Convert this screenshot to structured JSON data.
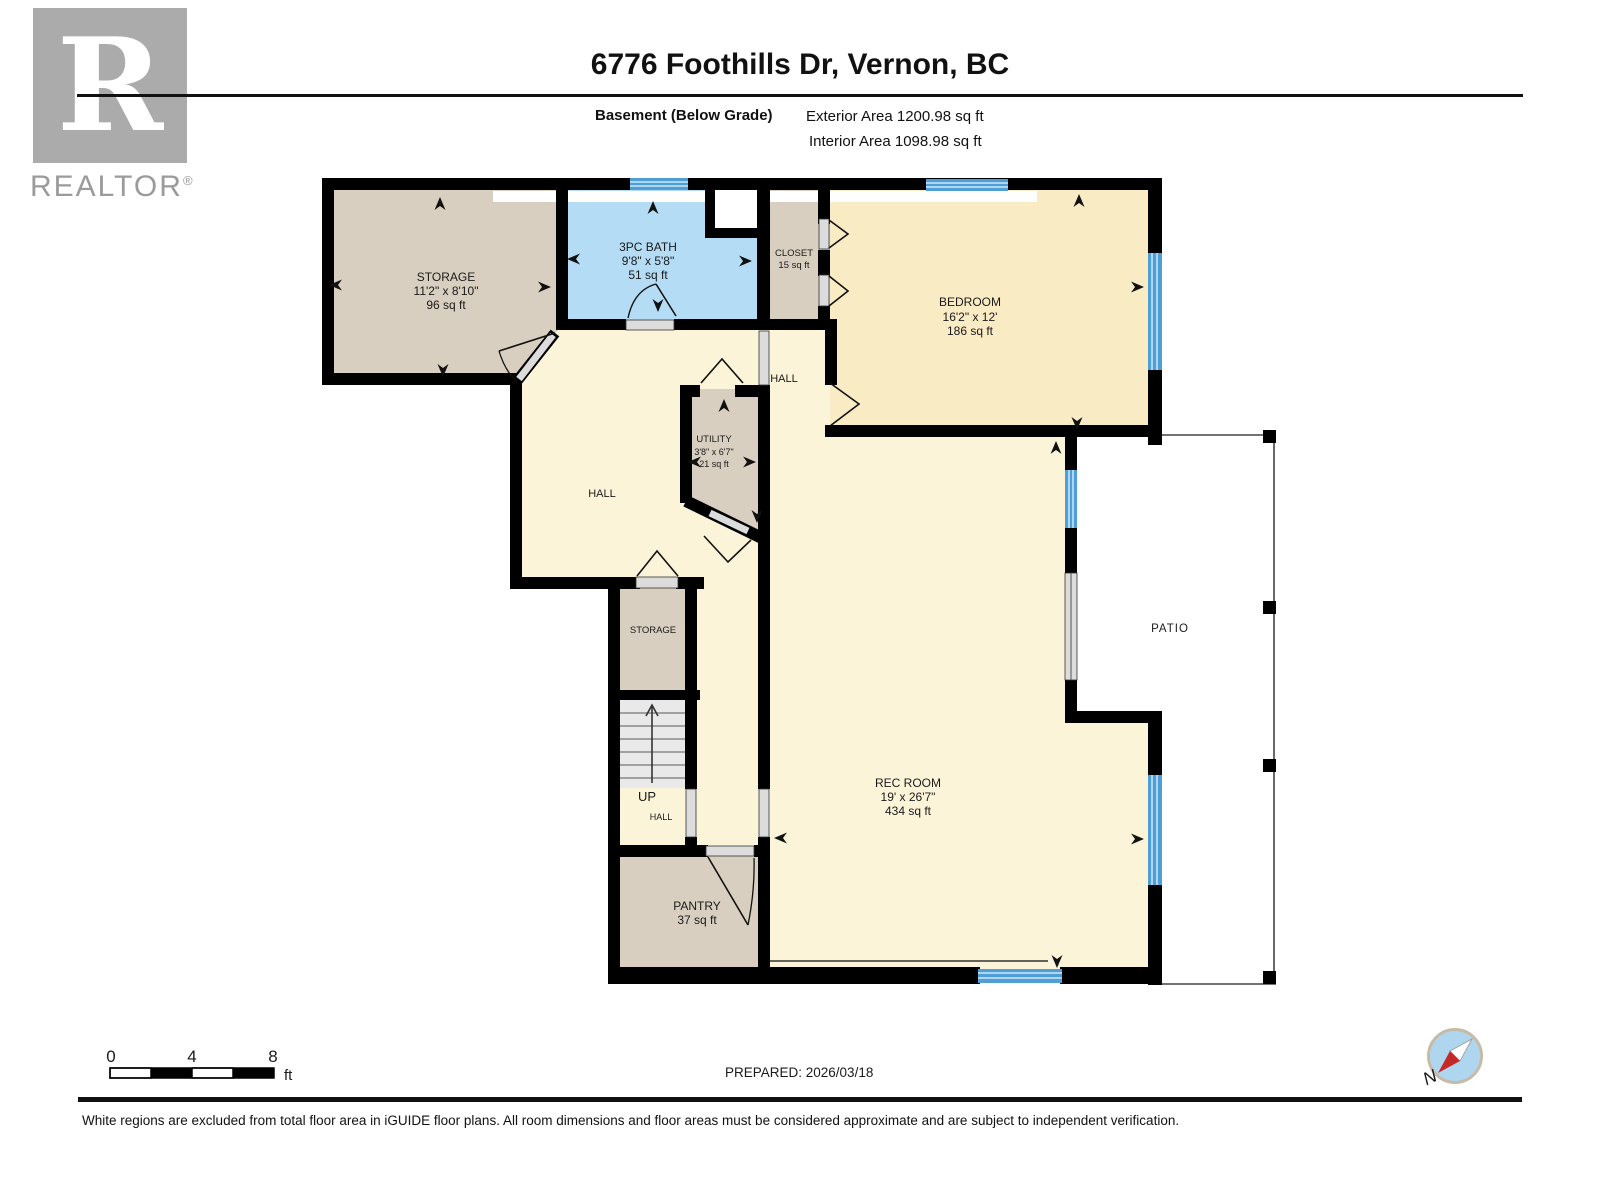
{
  "header": {
    "logo": {
      "letter": "R",
      "brand": "REALTOR",
      "reg": "®"
    },
    "title": "6776 Foothills Dr, Vernon, BC",
    "floor_label": "Basement (Below Grade)",
    "exterior_area": "Exterior Area 1200.98 sq ft",
    "interior_area": "Interior Area 1098.98 sq ft"
  },
  "plan": {
    "rooms": {
      "storage_main": {
        "name": "STORAGE",
        "dims": "11'2\" x 8'10\"",
        "area": "96 sq ft"
      },
      "bath": {
        "name": "3PC BATH",
        "dims": "9'8\" x 5'8\"",
        "area": "51 sq ft"
      },
      "closet": {
        "name": "CLOSET",
        "area": "15 sq ft"
      },
      "bedroom": {
        "name": "BEDROOM",
        "dims": "16'2\" x 12'",
        "area": "186 sq ft"
      },
      "utility": {
        "name": "UTILITY",
        "dims": "3'8\" x 6'7\"",
        "area": "21 sq ft"
      },
      "hall_left": {
        "name": "HALL"
      },
      "hall_right": {
        "name": "HALL"
      },
      "hall_small": {
        "name": "HALL"
      },
      "storage_small": {
        "name": "STORAGE"
      },
      "stairs": {
        "name": "UP"
      },
      "pantry": {
        "name": "PANTRY",
        "area": "37 sq ft"
      },
      "rec": {
        "name": "REC ROOM",
        "dims": "19' x 26'7\"",
        "area": "434 sq ft"
      },
      "patio": {
        "name": "PATIO"
      }
    },
    "colors": {
      "beige": "#d9cfc0",
      "hall_yellow": "#fcf4d8",
      "bedroom_yellow": "#f9ebc4",
      "bath_blue": "#b4dcf4",
      "window_blue": "#4e9fd6",
      "wall": "#000000",
      "door_gray": "#dcdcdc",
      "stairs_gray": "#e9e9e9"
    }
  },
  "footer": {
    "scale": {
      "t0": "0",
      "t4": "4",
      "t8": "8",
      "unit": "ft"
    },
    "prepared": "PREPARED: 2026/03/18",
    "compass_n": "N",
    "disclaimer": "White regions are excluded from total floor area in iGUIDE floor plans. All room dimensions and floor areas must be considered approximate and are subject to independent verification."
  }
}
